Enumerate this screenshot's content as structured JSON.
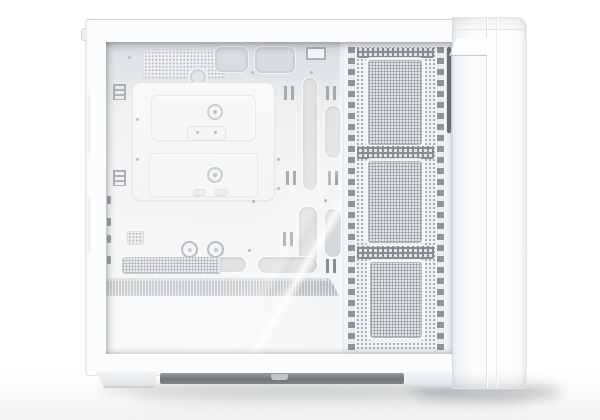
{
  "scene": {
    "description": "Studio product photo of a white mid-tower PC computer case viewed from its left side. A tempered glass side panel with a diagonal light reflection reveals an empty white interior; a perforated ventilation column with three fine-mesh fan zones runs along the front edge next to a smooth white front bezel. The case stands on two feet with a dark bottom dust filter, casting a soft shadow on a white floor.",
    "background_color": "#ffffff"
  },
  "pc_case": {
    "finish": "matte white",
    "fan_mesh_zones": 3,
    "colors": {
      "shell": "#fbfcfd",
      "interior_top_shade": "#c9cdd1",
      "interior_panel": "#f1f3f5",
      "cutout_grey": "#d2d5d8",
      "grommet_grey": "#c7cbcf",
      "mesh_hole_grey": "#a0a5aa",
      "fan_mesh_grey": "#e2e5e7",
      "accent_band_grey": "#b4b8bc",
      "dust_filter_dark": "#72777b",
      "dark_slot": "#6e7378",
      "floor_shadow": "rgba(120,125,130,0.35)"
    },
    "parts": {
      "glass_panel": {
        "label": "tempered glass side panel with diagonal reflection"
      },
      "top_vent": {
        "label": "perforated top vent"
      },
      "cable_grommets": {
        "label": "rubber-lined cable routing cutouts"
      },
      "motherboard_tray": {
        "label": "motherboard tray with two removable access covers and thumbscrews"
      },
      "cable_slots": {
        "label": "vertical cable routing slots"
      },
      "tie_anchors": {
        "label": "cable tie anchor points"
      },
      "psu_vent": {
        "label": "PSU shroud vent strip"
      },
      "accent_band": {
        "label": "grey textured accent band"
      },
      "mesh_column": {
        "label": "perforated front ventilation column with three fan mesh zones"
      },
      "front_bezel": {
        "label": "smooth white front panel"
      },
      "feet": {
        "label": "case feet with dark bottom dust filter"
      }
    }
  }
}
